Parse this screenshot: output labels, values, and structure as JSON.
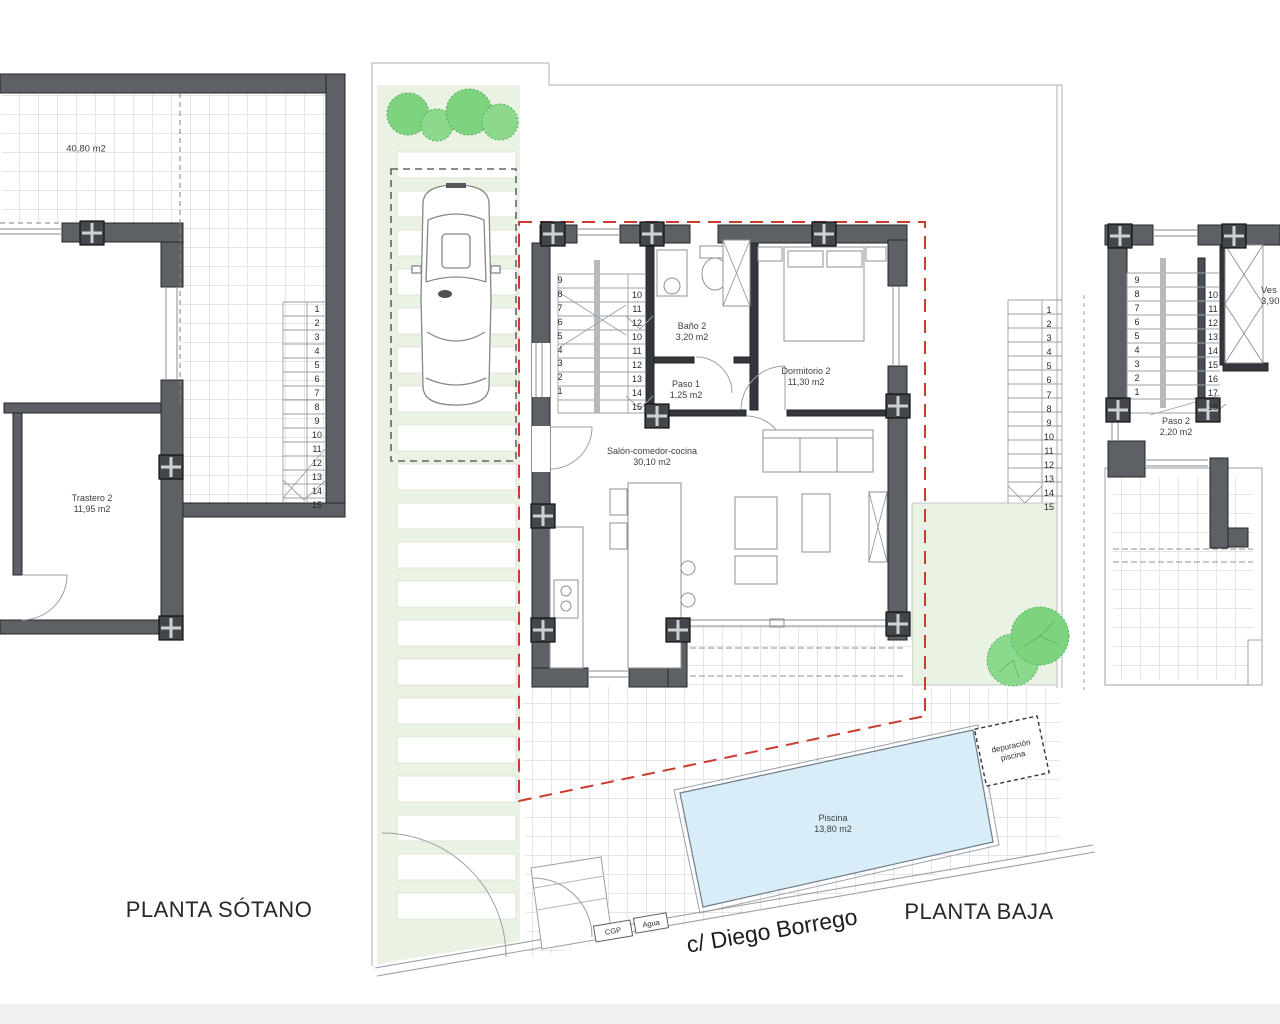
{
  "labels": {
    "basement_title": "PLANTA SÓTANO",
    "ground_title": "PLANTA BAJA",
    "street": "c/ Diego Borrego",
    "cgp": "CGP",
    "agua": "Agua"
  },
  "basement": {
    "open_area_area": "40,80 m2",
    "trastero_name": "Trastero 2",
    "trastero_area": "11,95 m2",
    "stair_numbers": [
      "1",
      "2",
      "3",
      "4",
      "5",
      "6",
      "7",
      "8",
      "9",
      "10",
      "11",
      "12",
      "13",
      "14",
      "15"
    ]
  },
  "ground": {
    "salon_name": "Salón-comedor-cocina",
    "salon_area": "30,10 m2",
    "bano_name": "Baño 2",
    "bano_area": "3,20 m2",
    "paso_name": "Paso 1",
    "paso_area": "1,25 m2",
    "dormitorio_name": "Dormitorio 2",
    "dormitorio_area": "11,30 m2",
    "piscina_name": "Piscina",
    "piscina_area": "13,80 m2",
    "depuracion_line1": "depuración",
    "depuracion_line2": "piscina",
    "stairs_left": [
      "9",
      "8",
      "7",
      "6",
      "5",
      "4",
      "3",
      "2",
      "1"
    ],
    "stairs_right": [
      "10",
      "11",
      "12",
      "10",
      "11",
      "12",
      "13",
      "14",
      "15"
    ],
    "exterior_stairs": [
      "1",
      "2",
      "3",
      "4",
      "5",
      "6",
      "7",
      "8",
      "9",
      "10",
      "11",
      "12",
      "13",
      "14",
      "15"
    ]
  },
  "first_floor": {
    "paso_name": "Paso 2",
    "paso_area": "2,20 m2",
    "vestidor_name": "Ves",
    "vestidor_area": "3,90",
    "stairs_left": [
      "9",
      "8",
      "7",
      "6",
      "5",
      "4",
      "3",
      "2",
      "1"
    ],
    "stairs_right": [
      "10",
      "11",
      "12",
      "13",
      "14",
      "15",
      "16",
      "17",
      "18"
    ]
  },
  "colors": {
    "wall": "#5d6165",
    "grid_line": "#c9cdd0",
    "green_area": "#e9f2e3",
    "bush_green": "#7ed37f",
    "pool_blue": "#d9edf9",
    "boundary_red": "#cc3b2e"
  }
}
